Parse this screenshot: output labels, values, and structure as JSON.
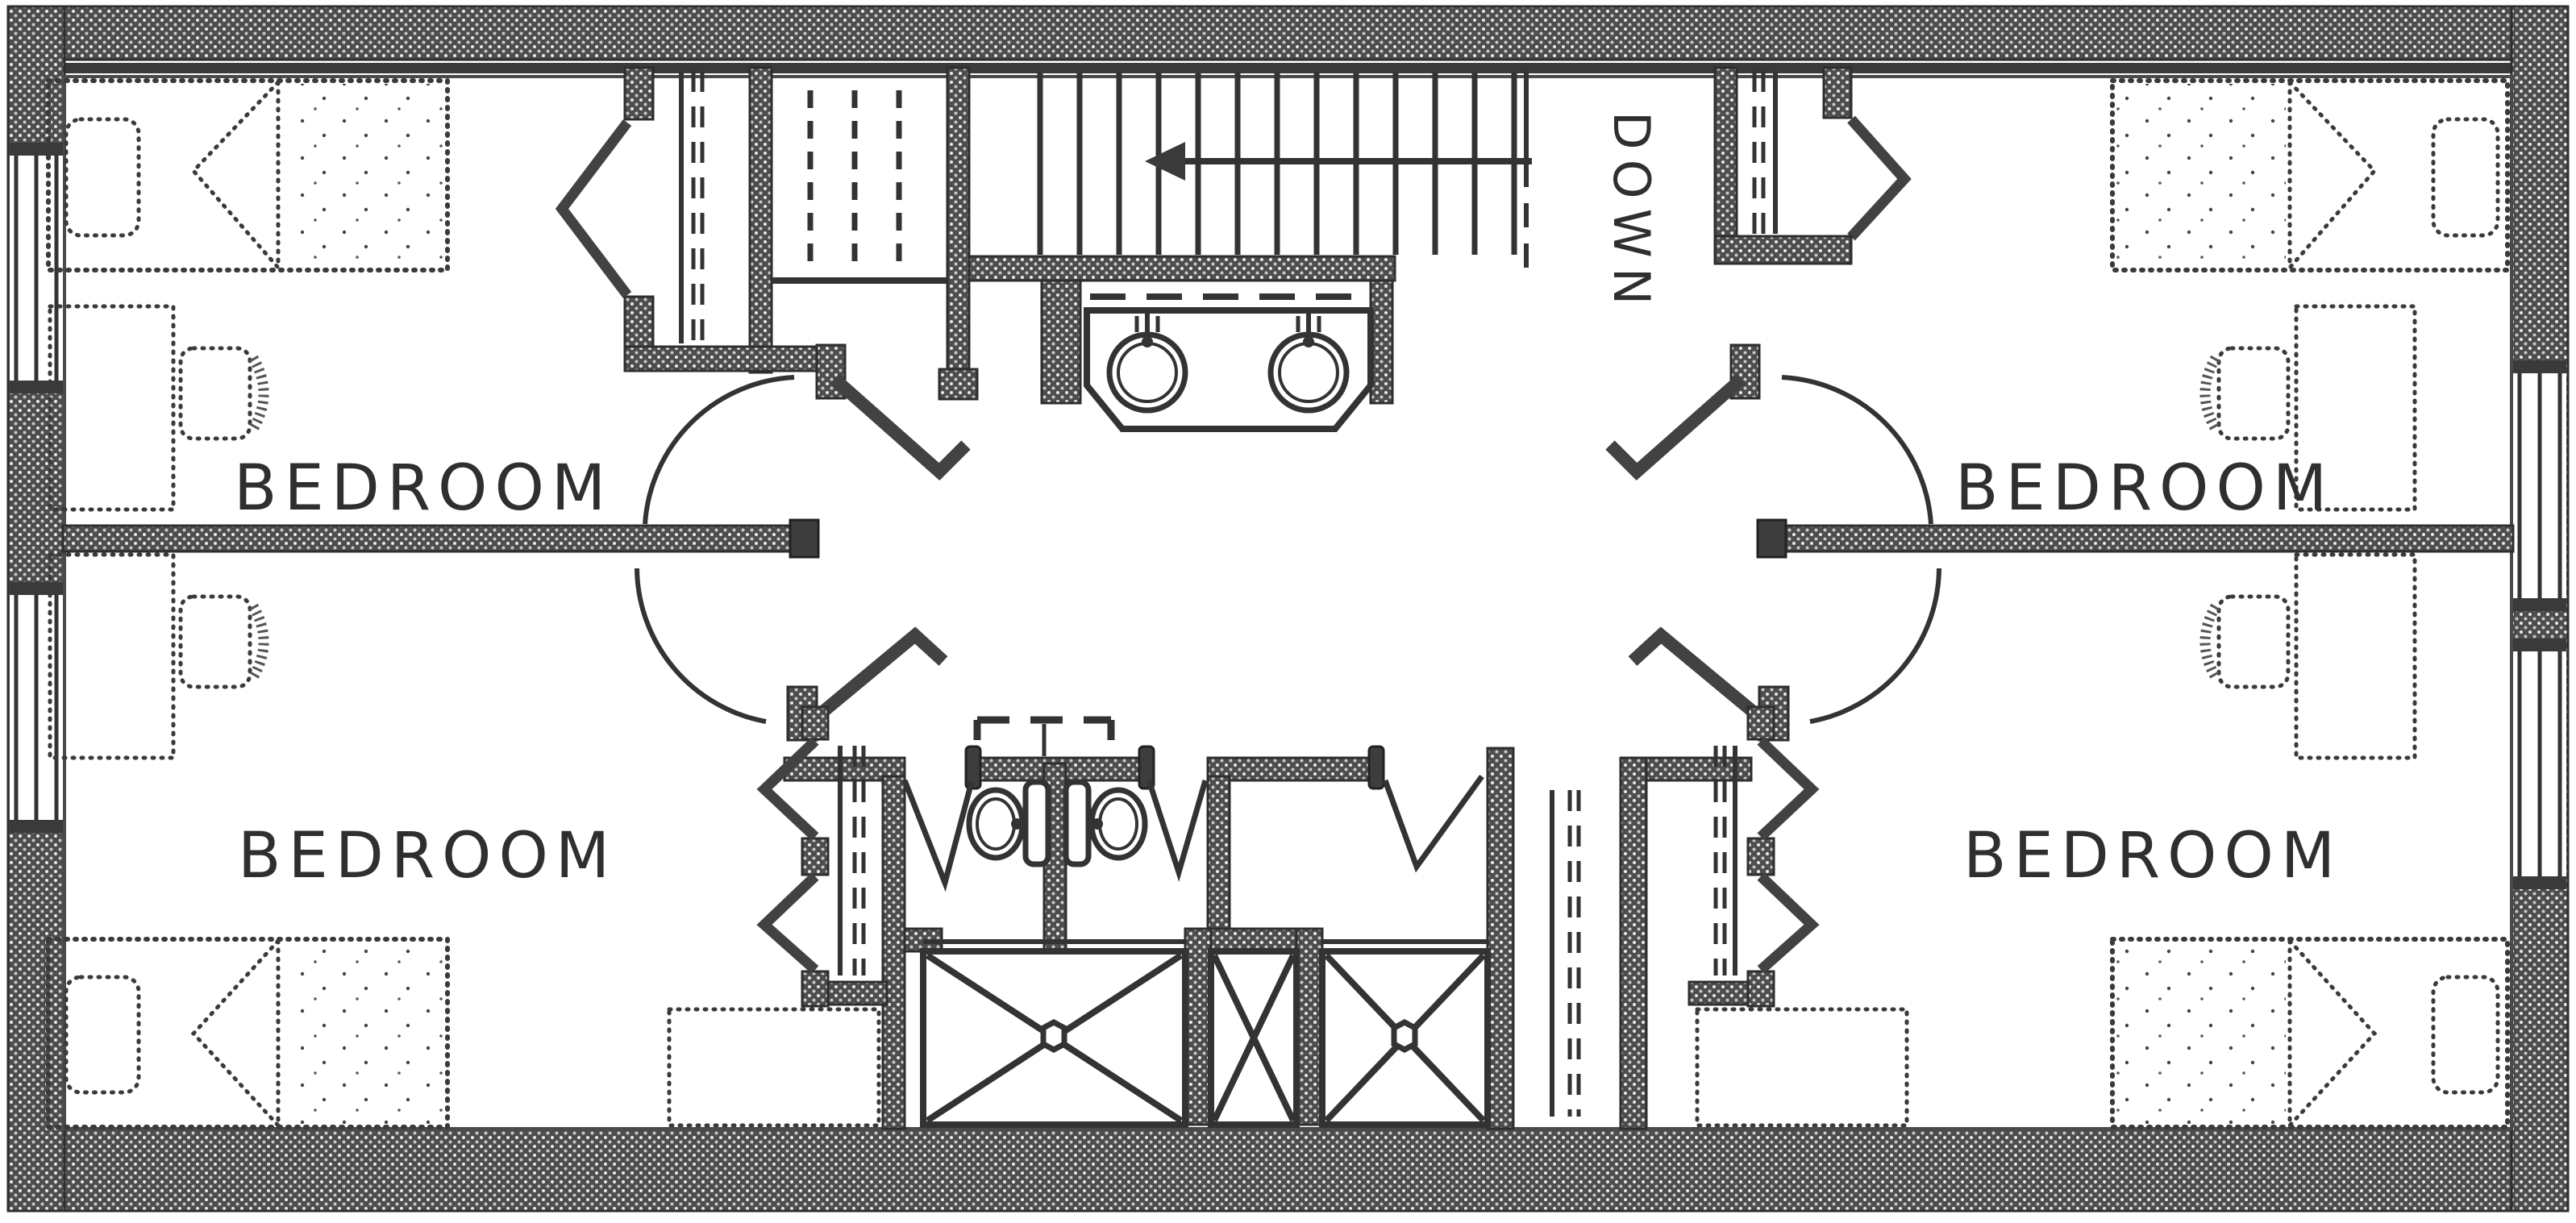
{
  "page": {
    "title": "Upper floor plan"
  },
  "rooms": [
    {
      "id": "bedroom-top-left",
      "label": "BEDROOM",
      "position": "top-left"
    },
    {
      "id": "bedroom-bottom-left",
      "label": "BEDROOM",
      "position": "bottom-left"
    },
    {
      "id": "bedroom-top-right",
      "label": "BEDROOM",
      "position": "top-right"
    },
    {
      "id": "bedroom-bottom-right",
      "label": "BEDROOM",
      "position": "bottom-right"
    }
  ],
  "stairs": {
    "label": "DOWN",
    "direction": "down",
    "arrow": "left"
  },
  "fixtures": {
    "sinks": 2,
    "toilets": 2,
    "showers": 3,
    "beds": 4,
    "desks": 4,
    "dressers": 2,
    "bifold_closets": 4,
    "shelf_closets": 2,
    "windows": 4
  },
  "colors": {
    "wall_fill": "#4d4d4d",
    "line": "#2e2e2e",
    "paper": "#ffffff"
  }
}
